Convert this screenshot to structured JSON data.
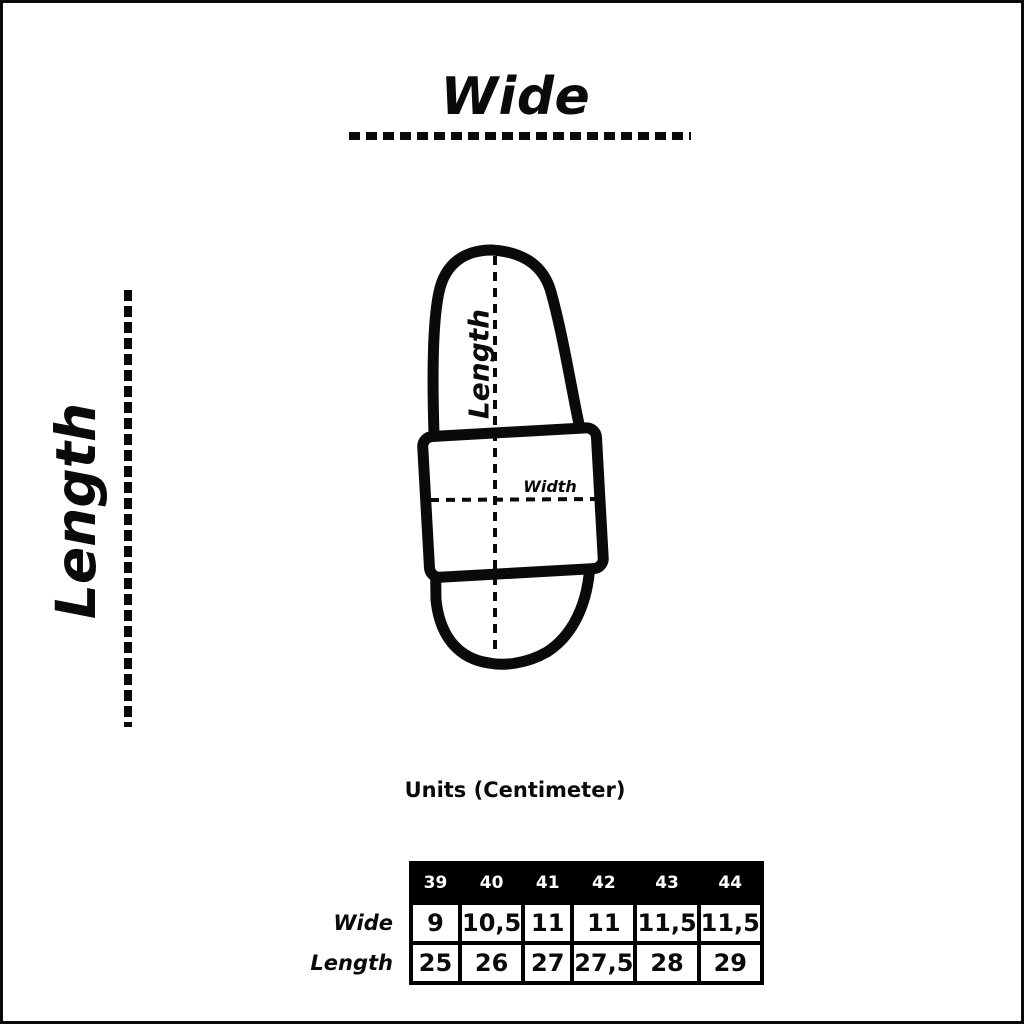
{
  "page": {
    "background": "#ffffff",
    "frame_color": "#0a0a0a"
  },
  "axes": {
    "top_label": "Wide",
    "left_label": "Length"
  },
  "diagram": {
    "length_label": "Length",
    "width_label": "Width"
  },
  "units_caption": "Units (Centimeter)",
  "size_table": {
    "header_bg": "#000000",
    "header_text_color": "#ffffff",
    "sizes": [
      "39",
      "40",
      "41",
      "42",
      "43",
      "44"
    ],
    "rows": [
      {
        "label": "Wide",
        "values": [
          "9",
          "10,5",
          "11",
          "11",
          "11,5",
          "11,5"
        ]
      },
      {
        "label": "Length",
        "values": [
          "25",
          "26",
          "27",
          "27,5",
          "28",
          "29"
        ]
      }
    ]
  }
}
